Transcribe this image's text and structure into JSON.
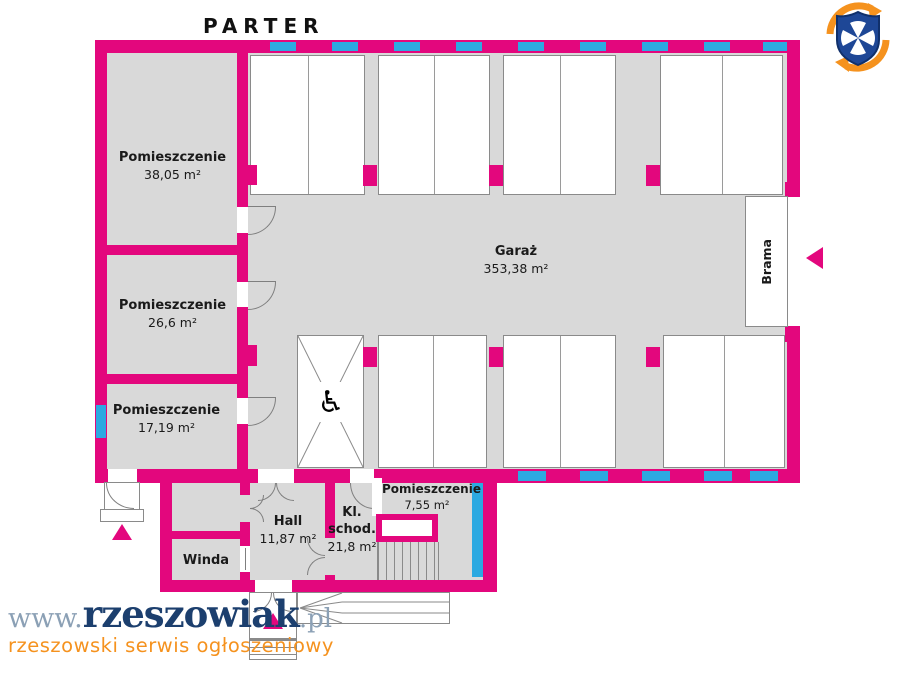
{
  "title": "PARTER",
  "rooms": {
    "r3805": {
      "label": "Pomieszczenie",
      "area": "38,05 m²"
    },
    "r266": {
      "label": "Pomieszczenie",
      "area": "26,6 m²"
    },
    "r1719": {
      "label": "Pomieszczenie",
      "area": "17,19 m²"
    },
    "garaz": {
      "label": "Garaż",
      "area": "353,38 m²"
    },
    "hall": {
      "label": "Hall",
      "area": "11,87 m²"
    },
    "klschod": {
      "line1": "Kl.",
      "line2": "schod.",
      "area": "21,8 m²"
    },
    "r755": {
      "label": "Pomieszczenie",
      "area": "7,55 m²"
    },
    "winda": {
      "label": "Winda"
    },
    "brama": {
      "label": "Brama"
    }
  },
  "icons": {
    "wheelchair": "♿"
  },
  "watermark": {
    "prefix": "www.",
    "brand": "rzeszowiak",
    "suffix": ".pl",
    "tagline": "rzeszowski serwis ogłoszeniowy"
  },
  "colors": {
    "wall_pink": "#E3077D",
    "window_blue": "#2CA9E1",
    "floor_gray": "#D9D9D9",
    "outline_gray": "#8a8a8a",
    "logo_navy": "#1E4796",
    "brand_navy": "#1C3F6E",
    "brand_slate": "#8BA0B5",
    "brand_orange": "#F5921E"
  }
}
